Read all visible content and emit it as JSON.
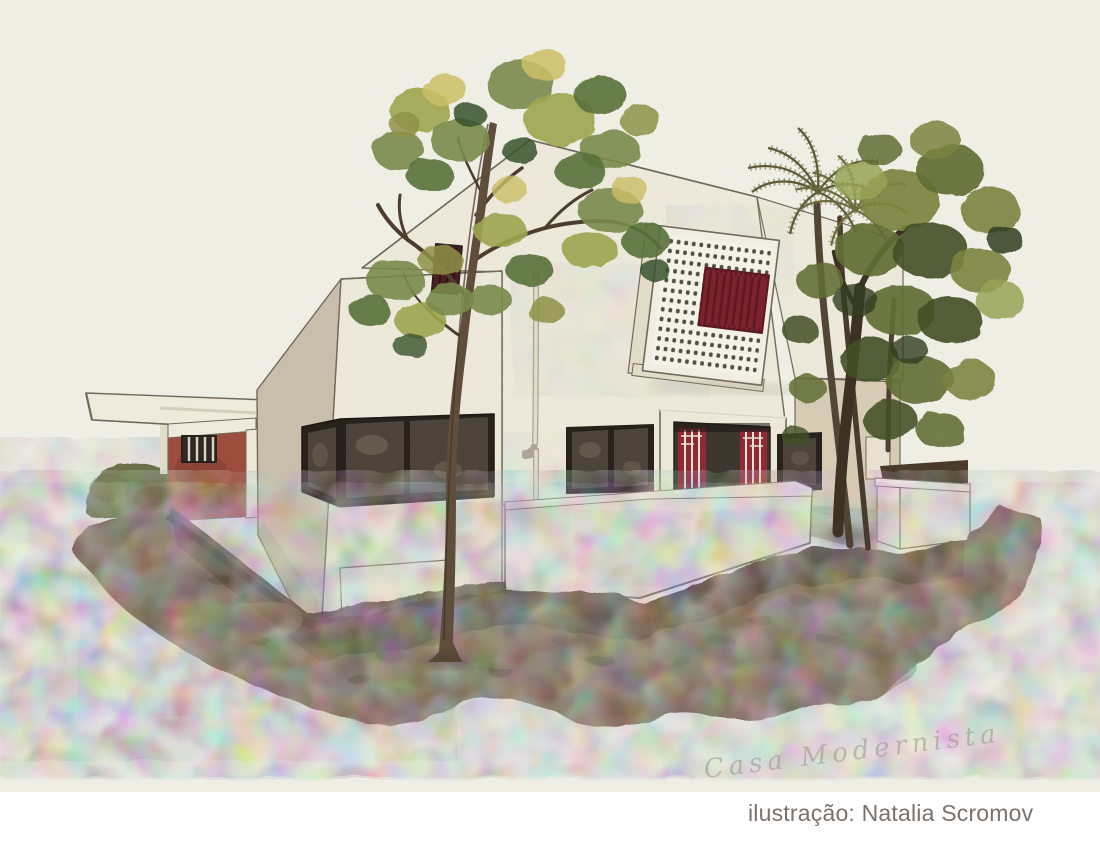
{
  "artwork": {
    "caption": "ilustração: Natalia Scromov",
    "signature": "Casa Modernista"
  },
  "palette": {
    "paper": "#f0f0e6",
    "strip": "#ffffff",
    "caption_text": "#7b726c",
    "pencil": "#94968b",
    "white_wall": "#edeadb",
    "white_wall2": "#e2ddc9",
    "canopy": "#efecdd",
    "shadow_wall": "#c8bfab",
    "wall_wash": "#d7cdb5",
    "outline": "#6f675a",
    "dark_line": "#3f362c",
    "frame_black": "#251e18",
    "glass_dark": "#4a4138",
    "glass_light": "#776a5c",
    "door_red": "#8e2633",
    "door_red_dark": "#571620",
    "cobogo_dot": "#4c4c3f",
    "cobogo_red": "#7c1f2a",
    "garage_red": "#9c4a3a",
    "garage_red_dark": "#7a352b",
    "hedge": "#6a6e44",
    "driveway": "#a39c95",
    "terrace_floor": "#b3aea0",
    "ground_brown": "#6f5b46",
    "ground_dark": "#423425",
    "ground_olive": "#77704a",
    "ground_pink": "#c69a85",
    "ground_red": "#b4705a",
    "trunk": "#5d4b38",
    "branch": "#4a3a2b",
    "trunk_dark": "#3a2e1f",
    "palm": "#5c5833",
    "palm2": "#6e6a3e",
    "g1": "#9ea54e",
    "g2": "#78894a",
    "g3": "#567038",
    "g4": "#cdbf66",
    "g5": "#35512b",
    "g6": "#8e9145",
    "o1": "#7a823e",
    "o2": "#5e6c30",
    "o3": "#3f4d22",
    "o4": "#97a455",
    "o5": "#2e3a1a"
  }
}
